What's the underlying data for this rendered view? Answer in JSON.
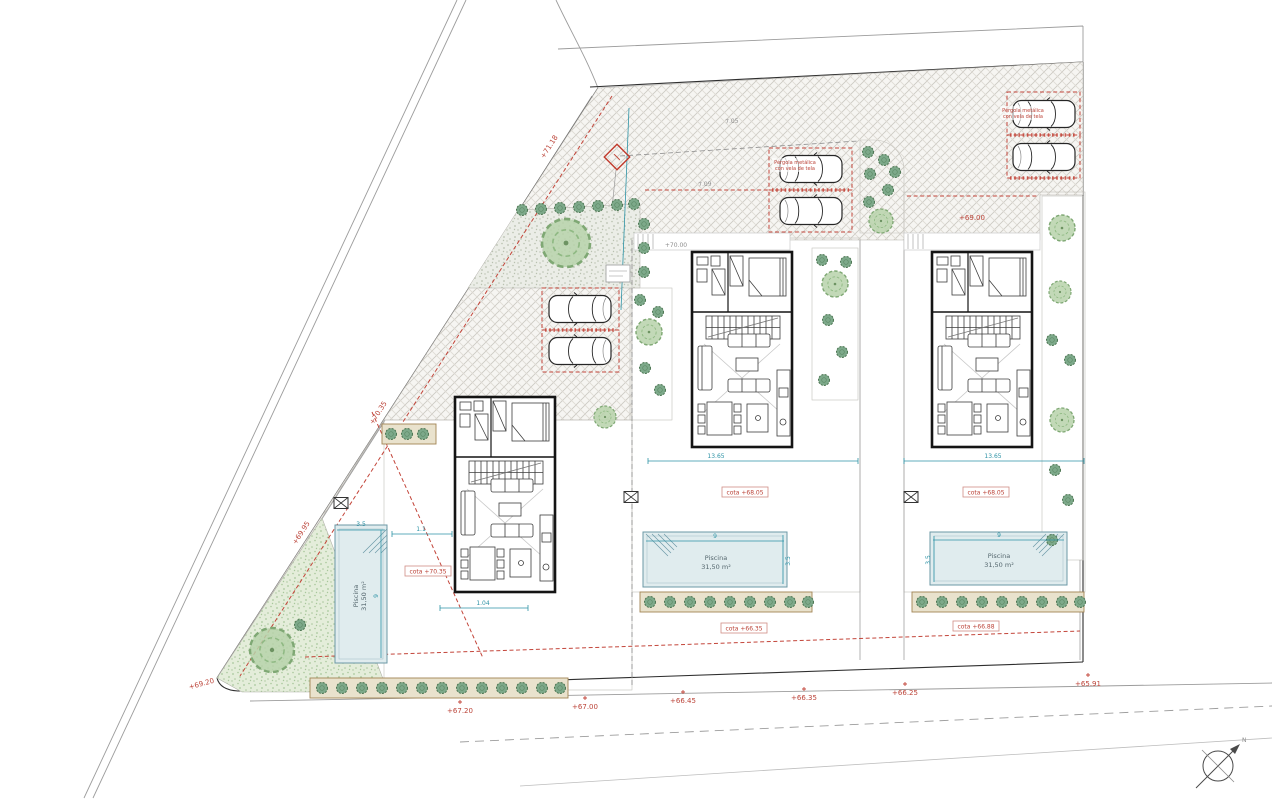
{
  "plan": {
    "pools": [
      {
        "name": "Piscina",
        "area": "31,50 m²"
      },
      {
        "name": "Piscina",
        "area": "31,50 m²"
      },
      {
        "name": "Piscina",
        "area": "31,50 m²"
      }
    ],
    "pergola_notes": [
      {
        "line1": "Pérgola metálica",
        "line2": "con vela de tela"
      },
      {
        "line1": "Pérgola metálica",
        "line2": "con vela de tela"
      }
    ],
    "cotas": {
      "villa1_terrace": "cota +70.35",
      "villa2_terrace": "cota +68.05",
      "villa3_terrace": "cota +68.05",
      "villa2_garden": "cota +66.35",
      "villa3_garden": "cota +66.88"
    },
    "elevations": {
      "road_upper": "+71.18",
      "road_mid": "+70.35",
      "road_lower": "+69.95",
      "corner_sw": "+69.20",
      "parking3": "+69.00",
      "entry2": "+70.00",
      "street": [
        "+67.20",
        "+67.00",
        "+66.45",
        "+66.35",
        "+66.25",
        "+65.91"
      ]
    },
    "dimensions": {
      "terrace_width2": "13.65",
      "terrace_width3": "13.65",
      "pool1_length": "9",
      "pool1_width": "3.5",
      "pool2_length": "9",
      "pool2_width": "3.5",
      "pool3_length": "9",
      "pool3_width": "3.5",
      "walk1": "1.1",
      "walk2": "1.04",
      "drive_upper": "7.05",
      "drive_lower": "7.09"
    },
    "compass": {
      "label": "N"
    },
    "colors": {
      "accent_red": "#bb4237",
      "dim_teal": "#2e93a6",
      "pool_fill": "#e0ecee"
    }
  }
}
